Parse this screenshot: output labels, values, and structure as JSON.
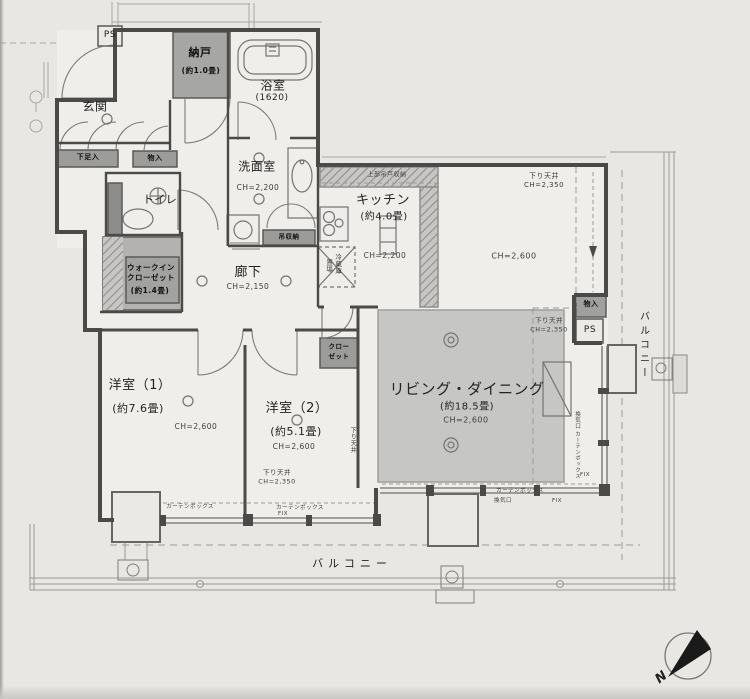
{
  "rooms": {
    "genkan": {
      "name": "玄関"
    },
    "nando": {
      "name": "納戸",
      "size": "(約1.0畳)"
    },
    "bathroom": {
      "name": "浴室",
      "size": "(1620)"
    },
    "washroom": {
      "name": "洗面室",
      "ch": "CH=2,200"
    },
    "toilet": {
      "name": "トイレ"
    },
    "wic": {
      "line1": "ウォークイン",
      "line2": "クローゼット",
      "size": "(約1.4畳)"
    },
    "hallway": {
      "name": "廊下",
      "ch": "CH=2,150"
    },
    "kitchen": {
      "name": "キッチン",
      "size": "(約4.0畳)",
      "ch": "CH=2,200",
      "upper_storage": "上部吊戸収納"
    },
    "living": {
      "name": "リビング・ダイニング",
      "size": "(約18.5畳)",
      "ch": "CH=2,600"
    },
    "bedroom1": {
      "name": "洋室（1）",
      "size": "(約7.6畳)",
      "ch": "CH=2,600"
    },
    "bedroom2": {
      "name": "洋室（2）",
      "size": "(約5.1畳)",
      "ch": "CH=2,600"
    },
    "balcony": {
      "name": "バルコニー"
    }
  },
  "storage": {
    "shoe_cabinet": "下足入",
    "entry_closet": "物入",
    "right_closet": "物入",
    "closet_line1": "クロー",
    "closet_line2": "ゼット",
    "hanging_storage": "吊収納",
    "fridge_line1": "冷蔵庫",
    "fridge_line2": "置場"
  },
  "annotations": {
    "ps": "PS",
    "fix": "FIX",
    "vent": "換気口",
    "curtain_box": "カーテンボックス",
    "lowered_ceiling": "下り天井",
    "ch_2350": "CH=2,350",
    "ch_2600": "CH=2,600",
    "compass_n": "N"
  },
  "colors": {
    "paper": "#e9e7e4",
    "wall": "#4a4a4a",
    "storage_fill": "#a6a6a6",
    "living_fill": "#c6c6c6"
  }
}
